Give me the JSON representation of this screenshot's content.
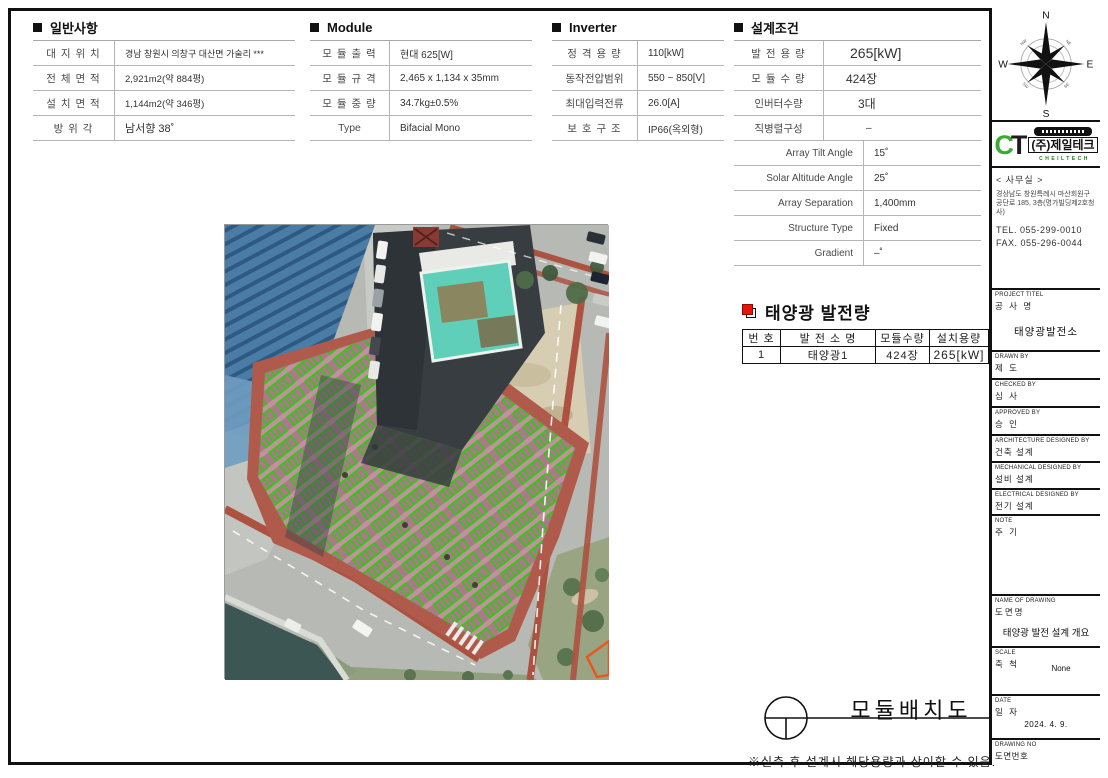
{
  "colors": {
    "panel_green": "#1ed400",
    "roof_light": "#bf939b",
    "roof_dark": "#a67c85",
    "brand_green": "#3aaa35",
    "marker_red": "#e8150d",
    "orange_outline": "#e8571f"
  },
  "general": {
    "title": "일반사항",
    "rows": [
      {
        "label": "대 지 위 치",
        "value": "경남 창원시 의창구 대산면 가술리 ***"
      },
      {
        "label": "전 체 면 적",
        "value": "2,921m2(약 884평)"
      },
      {
        "label": "설 치 면 적",
        "value": "1,144m2(약 346평)"
      },
      {
        "label": "방  위  각",
        "value": "남서향  38˚"
      }
    ]
  },
  "module": {
    "title": "Module",
    "rows": [
      {
        "label": "모 듈 출 력",
        "value": "현대 625[W]"
      },
      {
        "label": "모 듈 규 격",
        "value": "2,465 x 1,134 x 35mm"
      },
      {
        "label": "모 듈 중 량",
        "value": "34.7kg±0.5%"
      },
      {
        "label": "Type",
        "value": "Bifacial Mono"
      }
    ]
  },
  "inverter": {
    "title": "Inverter",
    "rows": [
      {
        "label": "정 격 용 량",
        "value": "110[kW]"
      },
      {
        "label": "동작전압범위",
        "value": "550 ~ 850[V]"
      },
      {
        "label": "최대입력전류",
        "value": "26.0[A]"
      },
      {
        "label": "보 호 구 조",
        "value": "IP66(옥외형)"
      }
    ]
  },
  "design": {
    "title": "설계조건",
    "rows": [
      {
        "label": "발 전 용 량",
        "value": "265[kW]"
      },
      {
        "label": "모 듈 수 량",
        "value": "424장"
      },
      {
        "label": "인버터수량",
        "value": "3대"
      },
      {
        "label": "직병렬구성",
        "value": "–"
      }
    ],
    "rows2": [
      {
        "label": "Array Tilt Angle",
        "value": "15˚"
      },
      {
        "label": "Solar Altitude Angle",
        "value": "25˚"
      },
      {
        "label": "Array Separation",
        "value": "1,400mm"
      },
      {
        "label": "Structure Type",
        "value": "Fixed"
      },
      {
        "label": "Gradient",
        "value": "–˚"
      }
    ]
  },
  "generation": {
    "title": "태양광 발전량",
    "headers": [
      "번 호",
      "발 전 소 명",
      "모듈수량",
      "설치용량"
    ],
    "row": [
      "1",
      "태양광1",
      "424장",
      "265[kW]"
    ]
  },
  "drawing_title": "모듈배치도",
  "footnote": "※실측 후 설계시 해당용량과 상이할 수 있음.",
  "compass": {
    "n": "N",
    "e": "E",
    "s": "S",
    "w": "W",
    "ne": "NE",
    "nw": "NW",
    "se": "SE",
    "sw": "SW"
  },
  "logo": {
    "ct_c": "C",
    "ct_t": "T",
    "kr": "(주)제일테크",
    "en": "CHEILTECH"
  },
  "office": {
    "header": "< 사무실 >",
    "addr1": "경상남도 창원특례시 마산회원구",
    "addr2": "공단로 185, 3층(명가빌딩제2호청사)",
    "tel": "TEL. 055-299-0010",
    "fax": "FAX. 055-296-0044"
  },
  "titleblock": {
    "project": {
      "en": "PROJECT TITEL",
      "kr": "공 사 명",
      "value": "태양광발전소"
    },
    "drawn": {
      "en": "DRAWN BY",
      "kr": "제 도"
    },
    "checked": {
      "en": "CHECKED BY",
      "kr": "심 사"
    },
    "approved": {
      "en": "APPROVED BY",
      "kr": "승 인"
    },
    "arch": {
      "en": "ARCHITECTURE DESIGNED BY",
      "kr": "건축 설계"
    },
    "mech": {
      "en": "MECHANICAL DESIGNED BY",
      "kr": "설비 설계"
    },
    "elec": {
      "en": "ELECTRICAL DESIGNED BY",
      "kr": "전기 설계"
    },
    "note": {
      "en": "NOTE",
      "kr": "주 기"
    },
    "name": {
      "en": "NAME OF DRAWING",
      "kr": "도면명",
      "value": "태양광 발전 설계 개요"
    },
    "scale": {
      "en": "SCALE",
      "kr": "축 척",
      "value": "None"
    },
    "date": {
      "en": "DATE",
      "kr": "일 자",
      "value": "2024. 4. 9."
    },
    "dwgno": {
      "en": "DRAWING NO",
      "kr": "도면번호"
    }
  }
}
